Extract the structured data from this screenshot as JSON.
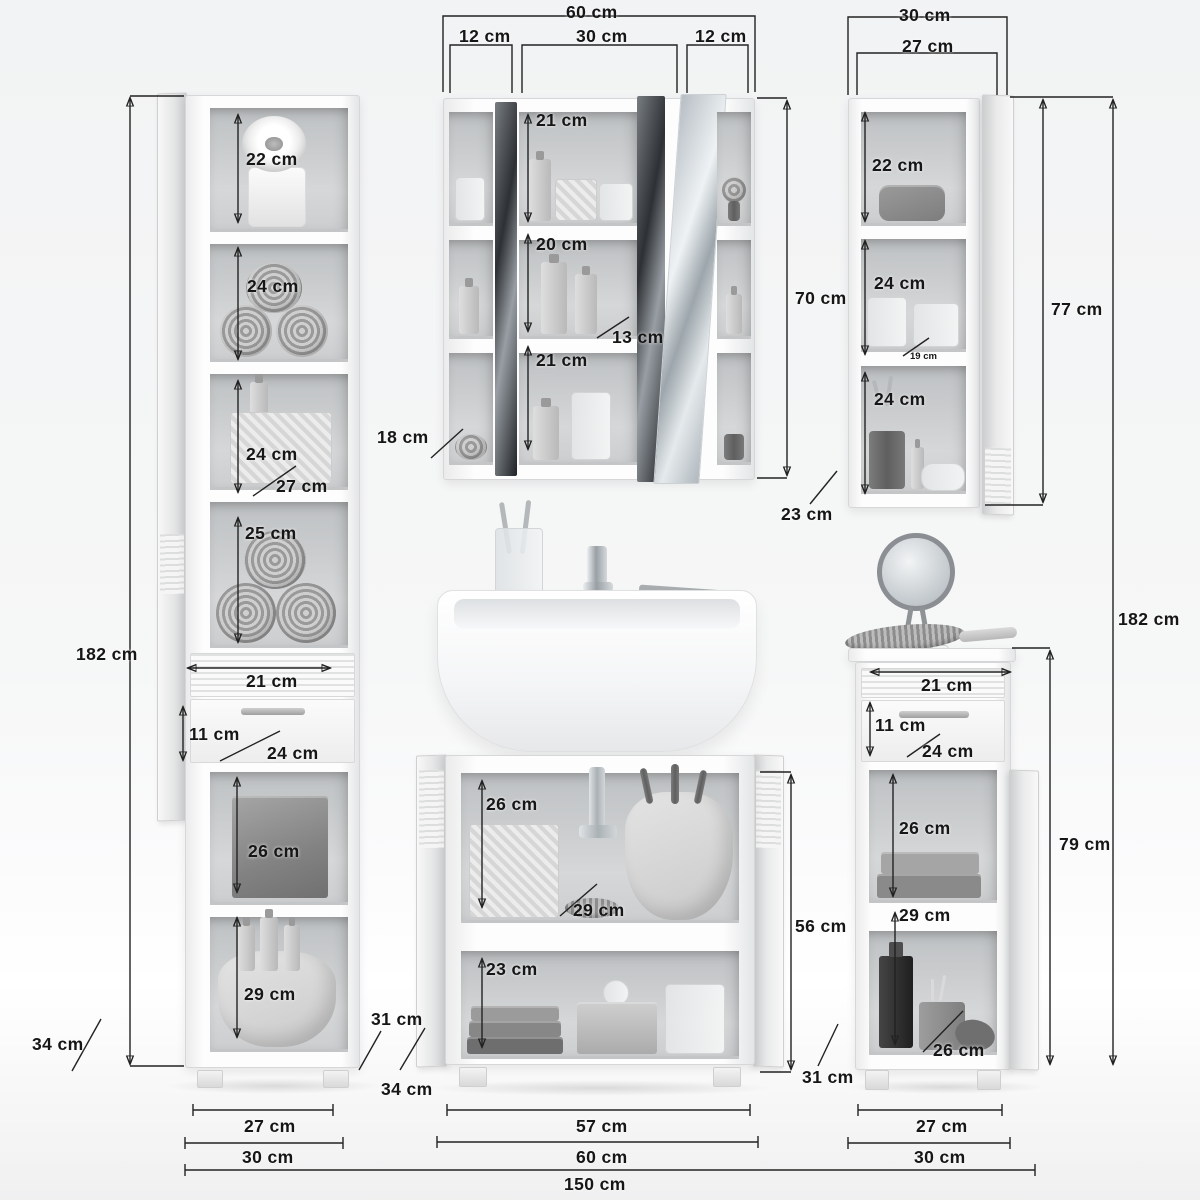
{
  "units": "cm",
  "overall": {
    "width": "150 cm",
    "height_left": "182 cm",
    "height_right": "182 cm"
  },
  "tall_cabinet": {
    "shelf_1_height": "22 cm",
    "shelf_2_height": "24 cm",
    "shelf_3_height": "24 cm",
    "shelf_3_depth": "27 cm",
    "shelf_4_height": "25 cm",
    "drawer_width": "21 cm",
    "drawer_height": "11 cm",
    "drawer_depth": "24 cm",
    "shelf_5_height": "26 cm",
    "shelf_6_height": "29 cm",
    "inner_width": "27 cm",
    "width": "30 cm",
    "base_depth": "34 cm",
    "body_depth": "31 cm"
  },
  "mirror_cabinet": {
    "width": "60 cm",
    "left_section_width": "12 cm",
    "center_section_width": "30 cm",
    "right_section_width": "12 cm",
    "shelf_top_height": "21 cm",
    "shelf_middle_height": "20 cm",
    "shelf_depth": "13 cm",
    "shelf_bottom_height": "21 cm",
    "height": "70 cm",
    "depth": "18 cm"
  },
  "wall_cabinet": {
    "width": "30 cm",
    "inner_width": "27 cm",
    "shelf_1_height": "22 cm",
    "shelf_2_height": "24 cm",
    "shelf_2_depth": "19 cm",
    "shelf_3_height": "24 cm",
    "height": "77 cm",
    "depth": "23 cm"
  },
  "vanity": {
    "shelf_1_height": "26 cm",
    "shelf_1_depth": "29 cm",
    "shelf_2_height": "23 cm",
    "height": "56 cm",
    "depth": "34 cm",
    "inner_width": "57 cm",
    "width": "60 cm"
  },
  "side_cabinet": {
    "drawer_width": "21 cm",
    "drawer_height": "11 cm",
    "drawer_depth": "24 cm",
    "shelf_1_height": "26 cm",
    "shelf_2_height": "29 cm",
    "shelf_2_depth": "26 cm",
    "height": "79 cm",
    "depth": "31 cm",
    "inner_width": "27 cm",
    "width": "30 cm"
  }
}
